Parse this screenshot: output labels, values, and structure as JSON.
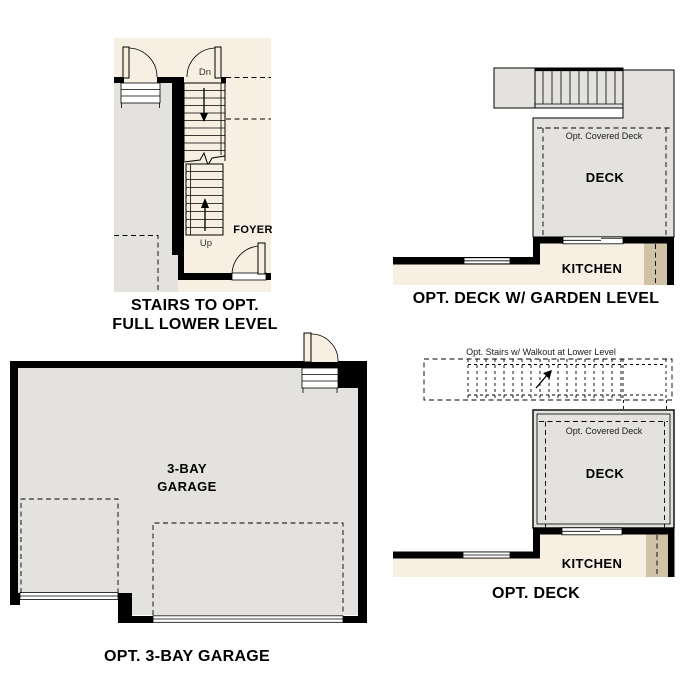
{
  "palette": {
    "cream": "#f7f0e2",
    "gray": "#e3e2df",
    "tan": "#cfc2a6",
    "wall": "#000000",
    "page": "#ffffff"
  },
  "stairs_plan": {
    "caption_line1": "STAIRS TO OPT.",
    "caption_line2": "FULL LOWER LEVEL",
    "down_label": "Dn",
    "up_label": "Up",
    "foyer_label": "FOYER"
  },
  "garden_deck_plan": {
    "caption": "OPT. DECK W/ GARDEN LEVEL",
    "covered_deck_label": "Opt. Covered Deck",
    "deck_label": "DECK",
    "kitchen_label": "KITCHEN"
  },
  "opt_deck_plan": {
    "caption": "OPT. DECK",
    "stairs_note": "Opt. Stairs w/ Walkout at Lower Level",
    "covered_deck_label": "Opt. Covered Deck",
    "deck_label": "DECK",
    "kitchen_label": "KITCHEN"
  },
  "garage_plan": {
    "caption": "OPT. 3-BAY GARAGE",
    "room_line1": "3-BAY",
    "room_line2": "GARAGE"
  }
}
